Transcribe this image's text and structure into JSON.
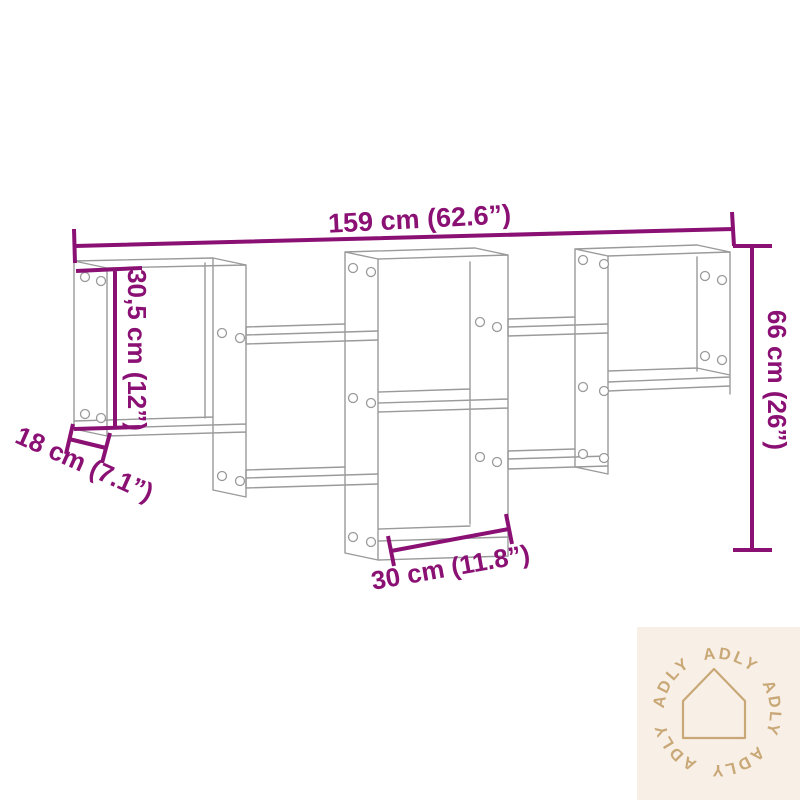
{
  "diagram": {
    "type": "product-dimension-diagram",
    "subject": "staggered wall shelf line drawing",
    "dimensions": {
      "overall_width": "159 cm (62.6”)",
      "overall_height": "66 cm (26”)",
      "compartment_height": "30,5 cm (12”)",
      "depth": "18 cm (7.1”)",
      "compartment_width": "30 cm (11.8”)"
    },
    "colors": {
      "dimension_accent": "#8a1074",
      "line_art": "#9a9a9a"
    }
  },
  "watermark": {
    "brand": "ADLY",
    "icon": "house-outline-icon",
    "background": "#f8efe6",
    "foreground": "#c9a877"
  }
}
